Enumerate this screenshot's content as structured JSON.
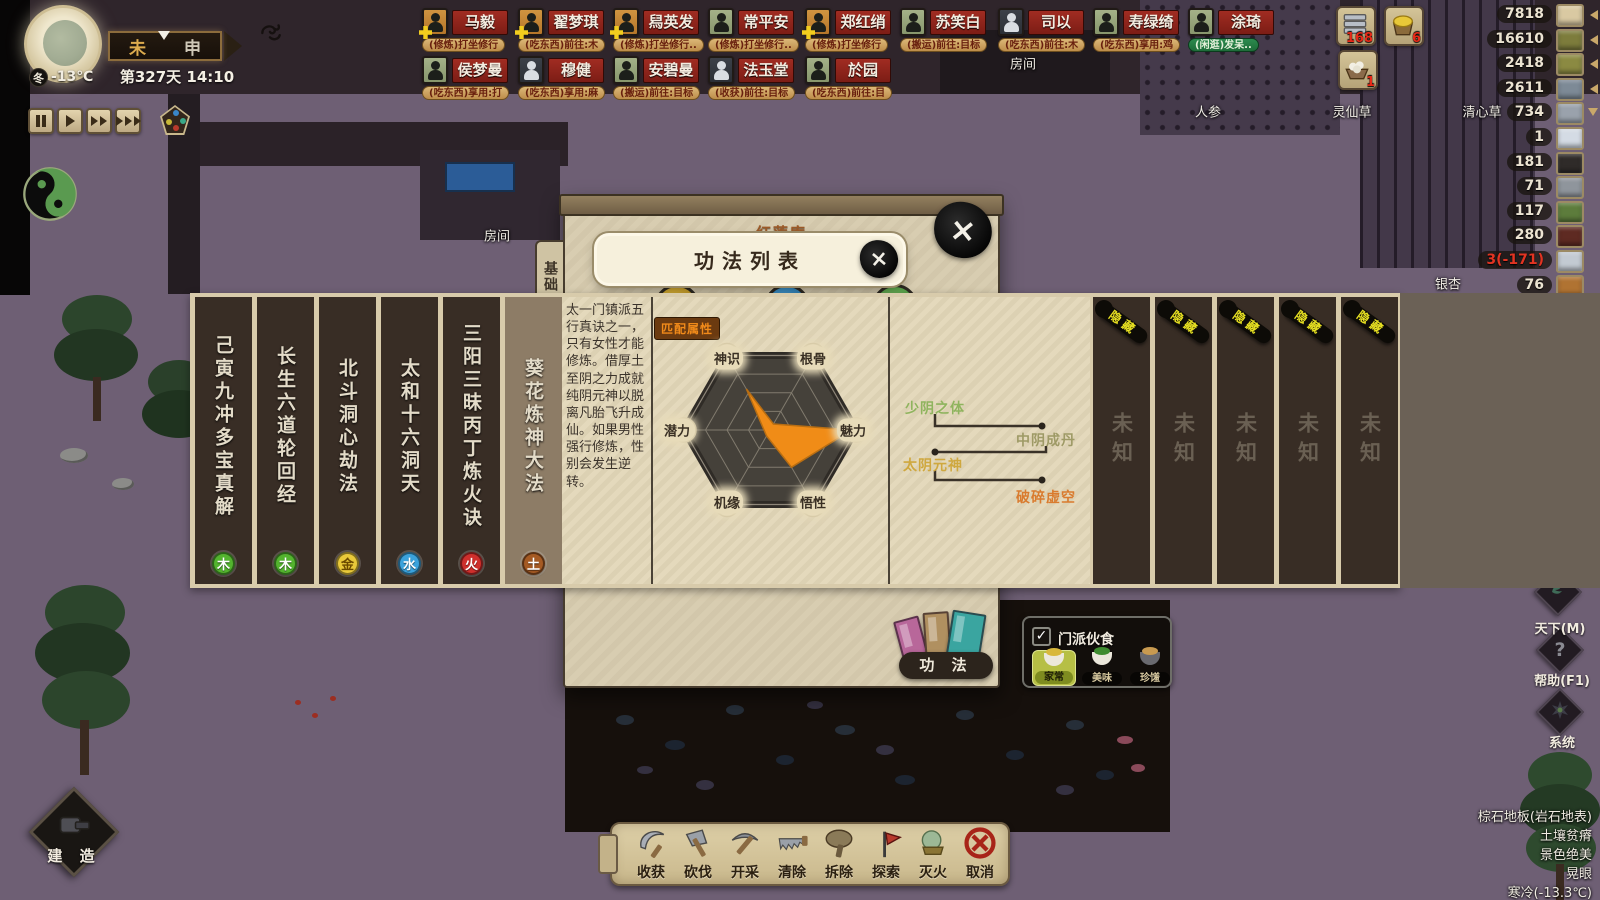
{
  "hud": {
    "clock": {
      "season": "冬",
      "temperature": "-13℃",
      "hour_from": "未",
      "hour_to": "申",
      "date_time": "第327天 14:10"
    },
    "alerts": [
      {
        "icon": "metal-bars-icon",
        "count": "168"
      },
      {
        "icon": "gold-basket-icon",
        "count": "6"
      },
      {
        "icon": "egg-bowl-icon",
        "count": "1"
      }
    ],
    "resources": [
      {
        "count": "7818",
        "icon": "cooked-food-icon",
        "color": "#d9c9a2",
        "arrow": "left"
      },
      {
        "count": "16610",
        "icon": "herb-icon",
        "color": "#7d7c3c",
        "arrow": "left"
      },
      {
        "count": "2418",
        "icon": "herb-icon",
        "color": "#8b8a42",
        "arrow": "left"
      },
      {
        "count": "2611",
        "icon": "fish-icon",
        "color": "#7d8a96",
        "arrow": "left"
      },
      {
        "count": "734",
        "icon": "metal-bar-icon",
        "color": "#9aa2ac",
        "arrow": "down"
      },
      {
        "count": "1",
        "icon": "bowl-icon",
        "color": "#d4dbe4"
      },
      {
        "count": "181",
        "icon": "coal-icon",
        "color": "#2f2b29"
      },
      {
        "count": "71",
        "icon": "iron-bar-icon",
        "color": "#8f959c"
      },
      {
        "count": "117",
        "icon": "plant-icon",
        "color": "#5d7c3c"
      },
      {
        "count": "280",
        "icon": "ore-icon",
        "color": "#5e2a22"
      },
      {
        "count": "3(-171)",
        "icon": "silver-bar-icon",
        "color": "#c3cad2",
        "negative": true
      },
      {
        "count": "76",
        "icon": "copper-bar-icon",
        "color": "#b07332"
      }
    ],
    "world_labels": [
      "人参",
      "灵仙草",
      "清心草",
      "银杏",
      "房间",
      "房间"
    ],
    "build_button": "建 造",
    "side_buttons": [
      {
        "label": "天下(M)",
        "icon": "world-map-icon"
      },
      {
        "label": "帮助(F1)",
        "icon": "help-icon"
      },
      {
        "label": "系统",
        "icon": "system-icon"
      }
    ],
    "tile_info": [
      "棕石地板(岩石地表)",
      "土壤贫瘠",
      "景色绝美",
      "晃眼",
      "寒冷(-13.3℃)"
    ],
    "toolbar": [
      {
        "label": "收获",
        "icon": "sickle-icon"
      },
      {
        "label": "砍伐",
        "icon": "axe-icon"
      },
      {
        "label": "开采",
        "icon": "pickaxe-icon"
      },
      {
        "label": "清除",
        "icon": "saw-icon"
      },
      {
        "label": "拆除",
        "icon": "mallet-icon"
      },
      {
        "label": "探索",
        "icon": "explore-icon"
      },
      {
        "label": "灭火",
        "icon": "extinguish-icon"
      },
      {
        "label": "取消",
        "icon": "cancel-icon"
      }
    ]
  },
  "characters": {
    "row1": [
      {
        "name": "马毅",
        "status": "(修炼)打坐修行",
        "avatar": "orange",
        "plus": true,
        "status_type": "orange"
      },
      {
        "name": "翟梦琪",
        "status": "(吃东西)前往:木",
        "avatar": "orange",
        "plus": true,
        "status_type": "orange"
      },
      {
        "name": "舄英发",
        "status": "(修炼)打坐修行..",
        "avatar": "orange",
        "plus": true,
        "status_type": "orange"
      },
      {
        "name": "常平安",
        "status": "(修炼)打坐修行..",
        "avatar": "green",
        "plus": false,
        "status_type": "orange"
      },
      {
        "name": "郑红绡",
        "status": "(修炼)打坐修行",
        "avatar": "orange",
        "plus": true,
        "status_type": "orange"
      },
      {
        "name": "苏笑白",
        "status": "(搬运)前往:目标",
        "avatar": "green",
        "plus": false,
        "status_type": "orange"
      },
      {
        "name": "司以",
        "status": "(吃东西)前往:木",
        "avatar": "dark",
        "plus": false,
        "status_type": "orange"
      },
      {
        "name": "寿绿绮",
        "status": "(吃东西)享用:鸡",
        "avatar": "green",
        "plus": false,
        "status_type": "orange"
      },
      {
        "name": "涂琦",
        "status": "(闲逛)发呆..",
        "avatar": "green",
        "plus": false,
        "status_type": "green"
      }
    ],
    "row2": [
      {
        "name": "侯梦曼",
        "status": "(吃东西)享用:打",
        "avatar": "green",
        "plus": false,
        "status_type": "orange"
      },
      {
        "name": "穆健",
        "status": "(吃东西)享用:麻",
        "avatar": "dark",
        "plus": false,
        "status_type": "orange"
      },
      {
        "name": "安碧曼",
        "status": "(搬运)前往:目标",
        "avatar": "green",
        "plus": false,
        "status_type": "orange"
      },
      {
        "name": "法玉堂",
        "status": "(收获)前往:目标",
        "avatar": "dark",
        "plus": false,
        "status_type": "orange"
      },
      {
        "name": "於园",
        "status": "(吃东西)前往:目",
        "avatar": "green",
        "plus": false,
        "status_type": "orange"
      }
    ]
  },
  "modal": {
    "room_title": "红莲庵",
    "dialog_title": "功法列表",
    "side_tab": "基础",
    "bottom_tab": "功 法",
    "close_icon": "×"
  },
  "panel": {
    "techniques": [
      {
        "name": "己寅九冲多宝真解",
        "element": "木",
        "element_color": "#53b42e",
        "selected": false
      },
      {
        "name": "长生六道轮回经",
        "element": "木",
        "element_color": "#53b42e",
        "selected": false
      },
      {
        "name": "北斗洞心劫法",
        "element": "金",
        "element_color": "#e9c93a",
        "selected": false
      },
      {
        "name": "太和十六洞天",
        "element": "水",
        "element_color": "#3ba2dc",
        "selected": false
      },
      {
        "name": "三阳三昧丙丁炼火诀",
        "element": "火",
        "element_color": "#cf2f2c",
        "selected": false
      },
      {
        "name": "葵花炼神大法",
        "element": "土",
        "element_color": "#a55a23",
        "selected": true
      }
    ],
    "description": "太一门镇派五行真诀之一，只有女性才能修炼。借厚土至阴之力成就纯阴元神以脱离凡胎飞升成仙。如果男性强行修炼，性别会发生逆转。",
    "radar": {
      "badge": "匹配属性",
      "axes": [
        {
          "label": "神识",
          "value": 0.55
        },
        {
          "label": "根骨",
          "value": 0.08
        },
        {
          "label": "魅力",
          "value": 0.95
        },
        {
          "label": "悟性",
          "value": 0.5
        },
        {
          "label": "机缘",
          "value": 0.08
        },
        {
          "label": "潜力",
          "value": 0.07
        }
      ]
    },
    "path": [
      {
        "label": "少阴之体",
        "color": "#8fb45e"
      },
      {
        "label": "中阴成丹",
        "color": "#9e9a66"
      },
      {
        "label": "太阴元神",
        "color": "#cfa83f"
      },
      {
        "label": "破碎虚空",
        "color": "#d97b2e"
      }
    ],
    "unknown": {
      "label": "未知",
      "ribbon": "隐藏",
      "count": 5
    }
  },
  "food_panel": {
    "title": "门派伙食",
    "check_icon": "✓",
    "options": [
      {
        "label": "家常",
        "selected": true
      },
      {
        "label": "美味",
        "selected": false
      },
      {
        "label": "珍馐",
        "selected": false
      }
    ]
  },
  "chart_data": {
    "type": "radar",
    "title": "匹配属性",
    "categories": [
      "神识",
      "根骨",
      "魅力",
      "悟性",
      "机缘",
      "潜力"
    ],
    "values": [
      0.55,
      0.08,
      0.95,
      0.5,
      0.08,
      0.07
    ],
    "range": [
      0,
      1
    ]
  }
}
